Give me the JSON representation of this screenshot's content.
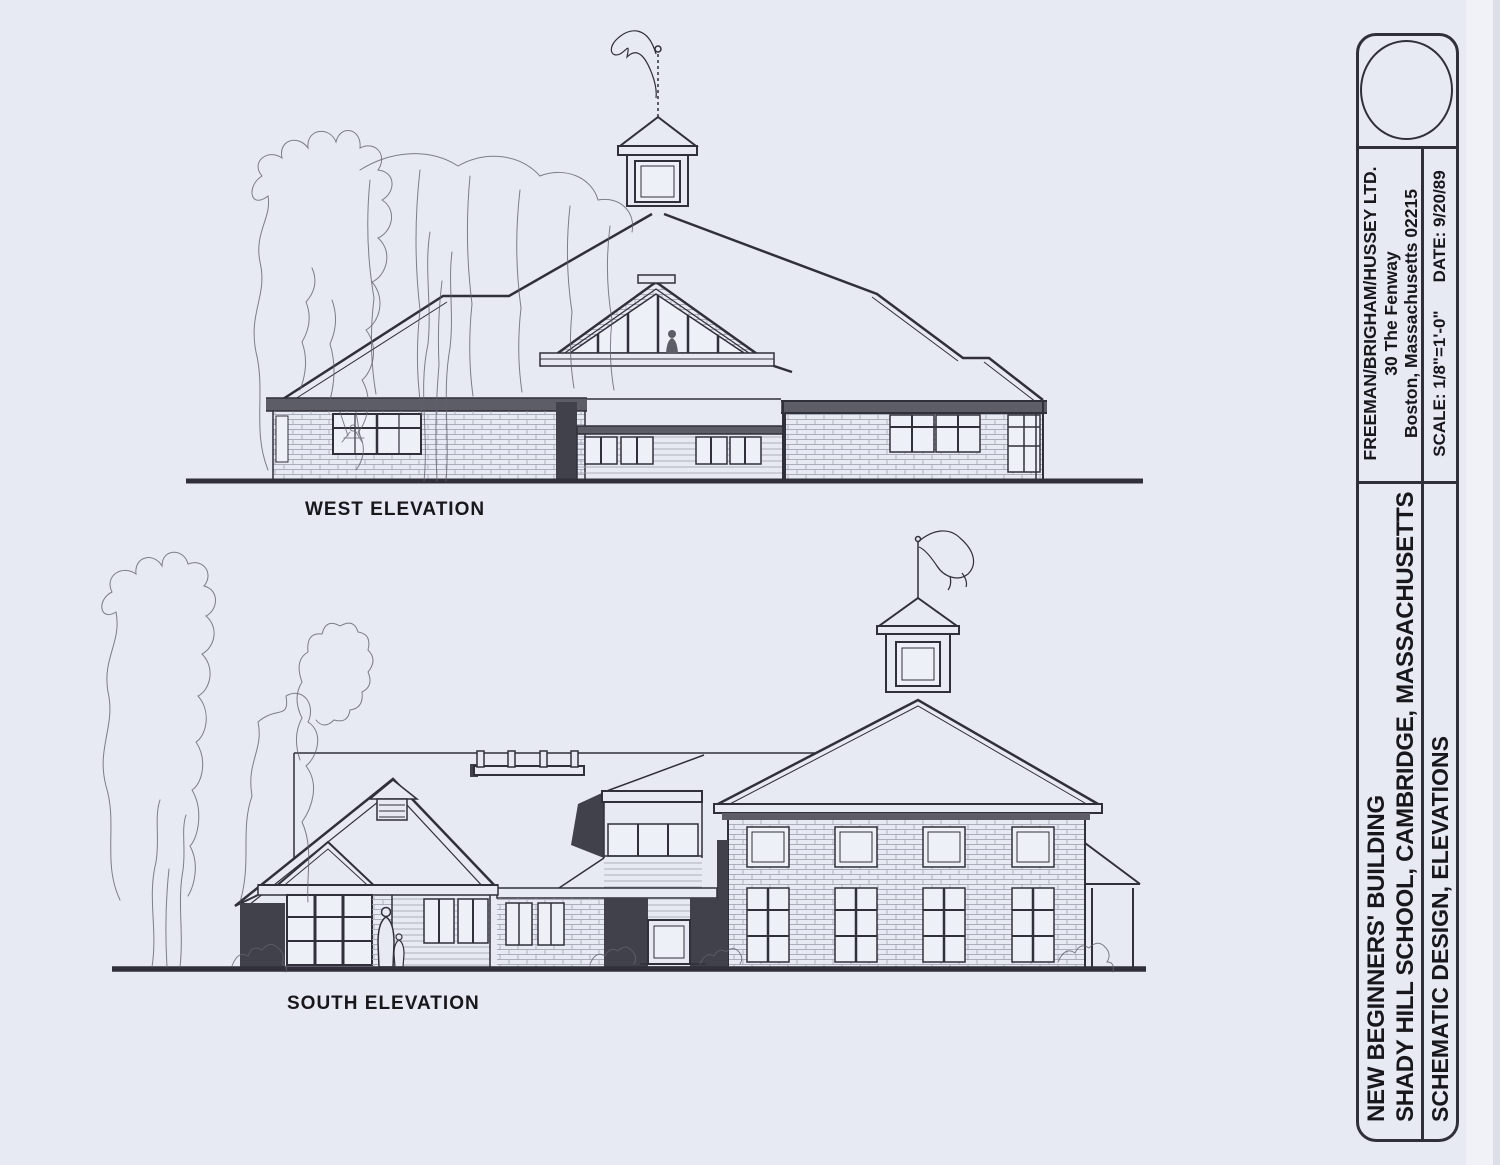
{
  "sheet": {
    "drawings": {
      "west": {
        "label": "WEST ELEVATION"
      },
      "south": {
        "label": "SOUTH ELEVATION"
      }
    },
    "title_block": {
      "firm_name": "FREEMAN/BRIGHAM/HUSSEY LTD.",
      "firm_address_line1": "30 The Fenway",
      "firm_address_line2": "Boston, Massachusetts  02215",
      "scale_label": "SCALE: 1/8\"=1'-0\"",
      "date_label": "DATE: 9/20/89",
      "project_line1": "NEW BEGINNERS' BUILDING",
      "project_line2": "SHADY HILL SCHOOL, CAMBRIDGE, MASSACHUSETTS",
      "sheet_title": "SCHEMATIC DESIGN, ELEVATIONS"
    }
  },
  "colors": {
    "paper": "#e7e9f3",
    "margin": "#f1f2f8",
    "edge": "#dcdee8",
    "ink": "#30303a",
    "text": "#17171c",
    "shade_dark": "#41414b",
    "shade_mid": "#5d5d68",
    "glass": "#eef0f7",
    "hatch": "#989cac",
    "tree": "#61616f"
  }
}
